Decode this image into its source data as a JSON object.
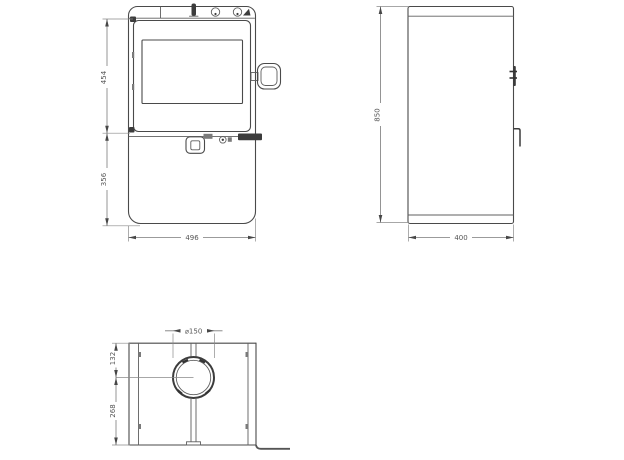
{
  "drawing": {
    "background": "#ffffff",
    "line_color": "#4a4a4a",
    "dimension_color": "#555555",
    "front_view": {
      "upper_height": "454",
      "lower_height": "356",
      "width": "496"
    },
    "side_view": {
      "height": "850",
      "depth": "400"
    },
    "plan_view": {
      "flue_diameter": "⌀150",
      "flue_center_offset_top": "132",
      "flue_center_offset_bottom": "268"
    }
  }
}
